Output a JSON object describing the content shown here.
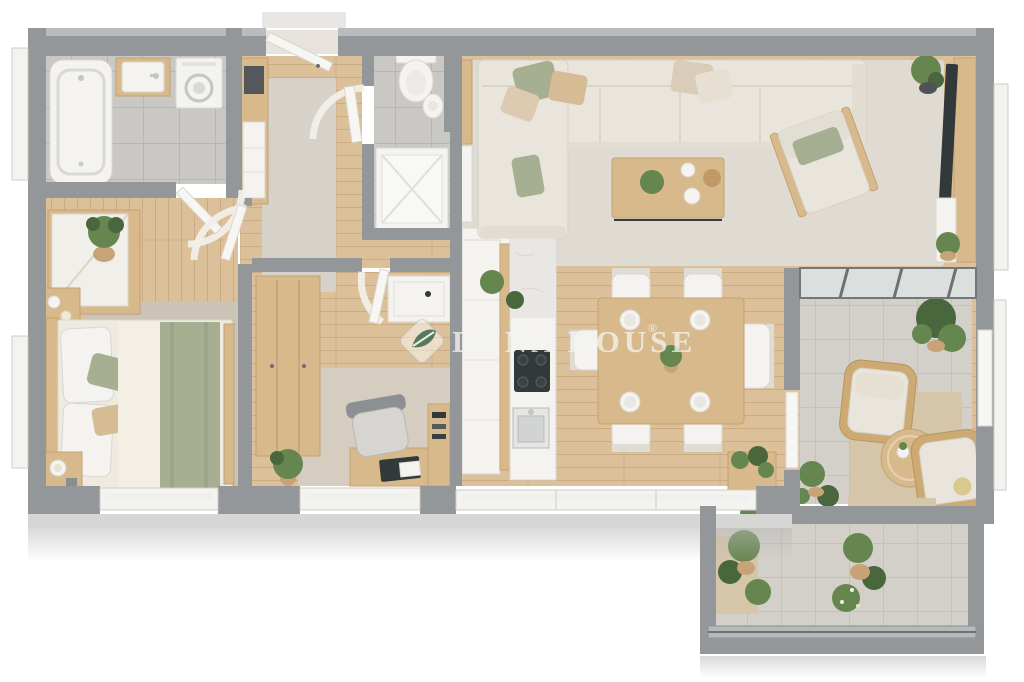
{
  "watermark": {
    "brand": "DUNA HOUSE",
    "registered": "®",
    "logo": "leaf-in-diamond"
  },
  "palette": {
    "wall": "#94979a",
    "wallCap": "#b9bcbe",
    "wallSide": "#d5d6d4",
    "woodFloor": "#dcc099",
    "tile": "#c9c8c4",
    "terrace": "#d3d0c9",
    "rugLiving": "#dfdbd3",
    "rugBed": "#ccc4b6",
    "rugOffice": "#d5cdc0",
    "runner": "#d6d1c9",
    "jute": "#d5c6a9",
    "cream": "#e9e5dc",
    "creamEdge": "#d5d1c5",
    "sage": "#a6af92",
    "tanPillow": "#d6bc95",
    "wood": "#d8b98c",
    "woodDark": "#c3a172",
    "white": "#f4f3f0",
    "whiteEdge": "#d9d7d1",
    "dark": "#32393b",
    "steel": "#c3c6c5",
    "plant": "#66864f",
    "plantDark": "#49663c",
    "pot": "#c7a377",
    "marble": "#e9e7e3",
    "glass": "#dbe0df"
  },
  "plan": {
    "type": "3d-top-down-apartment-floor-plan",
    "rooms": [
      {
        "id": "bathroom",
        "floor": "grey-tile",
        "furniture": [
          "bathtub",
          "vanity-washbasin",
          "washing-machine"
        ]
      },
      {
        "id": "entry-hall",
        "floor": "wood",
        "furniture": [
          "entrance-door",
          "runner-rug",
          "hall-cabinet-with-mirror",
          "open-doors-with-swing-arcs"
        ]
      },
      {
        "id": "toilet-room",
        "floor": "grey-tile",
        "furniture": [
          "toilet",
          "bidet",
          "shower-tray",
          "cistern-panel"
        ]
      },
      {
        "id": "bedroom",
        "floor": "wood",
        "furniture": [
          "double-bed",
          "sage-green-throw",
          "wardrobe",
          "potted-plant",
          "nightstand-with-candles",
          "second-nightstand",
          "area-rug"
        ]
      },
      {
        "id": "study-room",
        "floor": "wood",
        "furniture": [
          "wardrobe",
          "desk",
          "office-chair",
          "laptop",
          "book-shelf",
          "white-side-table",
          "potted-plant",
          "area-rug"
        ]
      },
      {
        "id": "kitchen",
        "floor": "wood",
        "furniture": [
          "cabinet-run",
          "marble-counter",
          "gas-hob",
          "sink",
          "herb-plants"
        ]
      },
      {
        "id": "dining-area",
        "floor": "wood",
        "furniture": [
          "dining-table",
          "six-chairs",
          "four-place-settings",
          "centerpiece-plant",
          "planter-box"
        ]
      },
      {
        "id": "living-room",
        "floor": "wood",
        "furniture": [
          "l-shaped-sectional-sofa",
          "throw-pillows",
          "coffee-table",
          "armchair",
          "tv-on-media-wall",
          "white-console",
          "radiator",
          "potted-plants",
          "large-area-rug"
        ]
      },
      {
        "id": "winter-garden",
        "floor": "stone-tile",
        "furniture": [
          "rattan-armchair-left",
          "rattan-armchair-right",
          "round-coffee-table",
          "jute-rug",
          "potted-plants",
          "glass-roof"
        ]
      },
      {
        "id": "balcony",
        "floor": "stone-tile",
        "furniture": [
          "potted-plants",
          "glass-railing",
          "jute-doormat"
        ]
      }
    ]
  }
}
